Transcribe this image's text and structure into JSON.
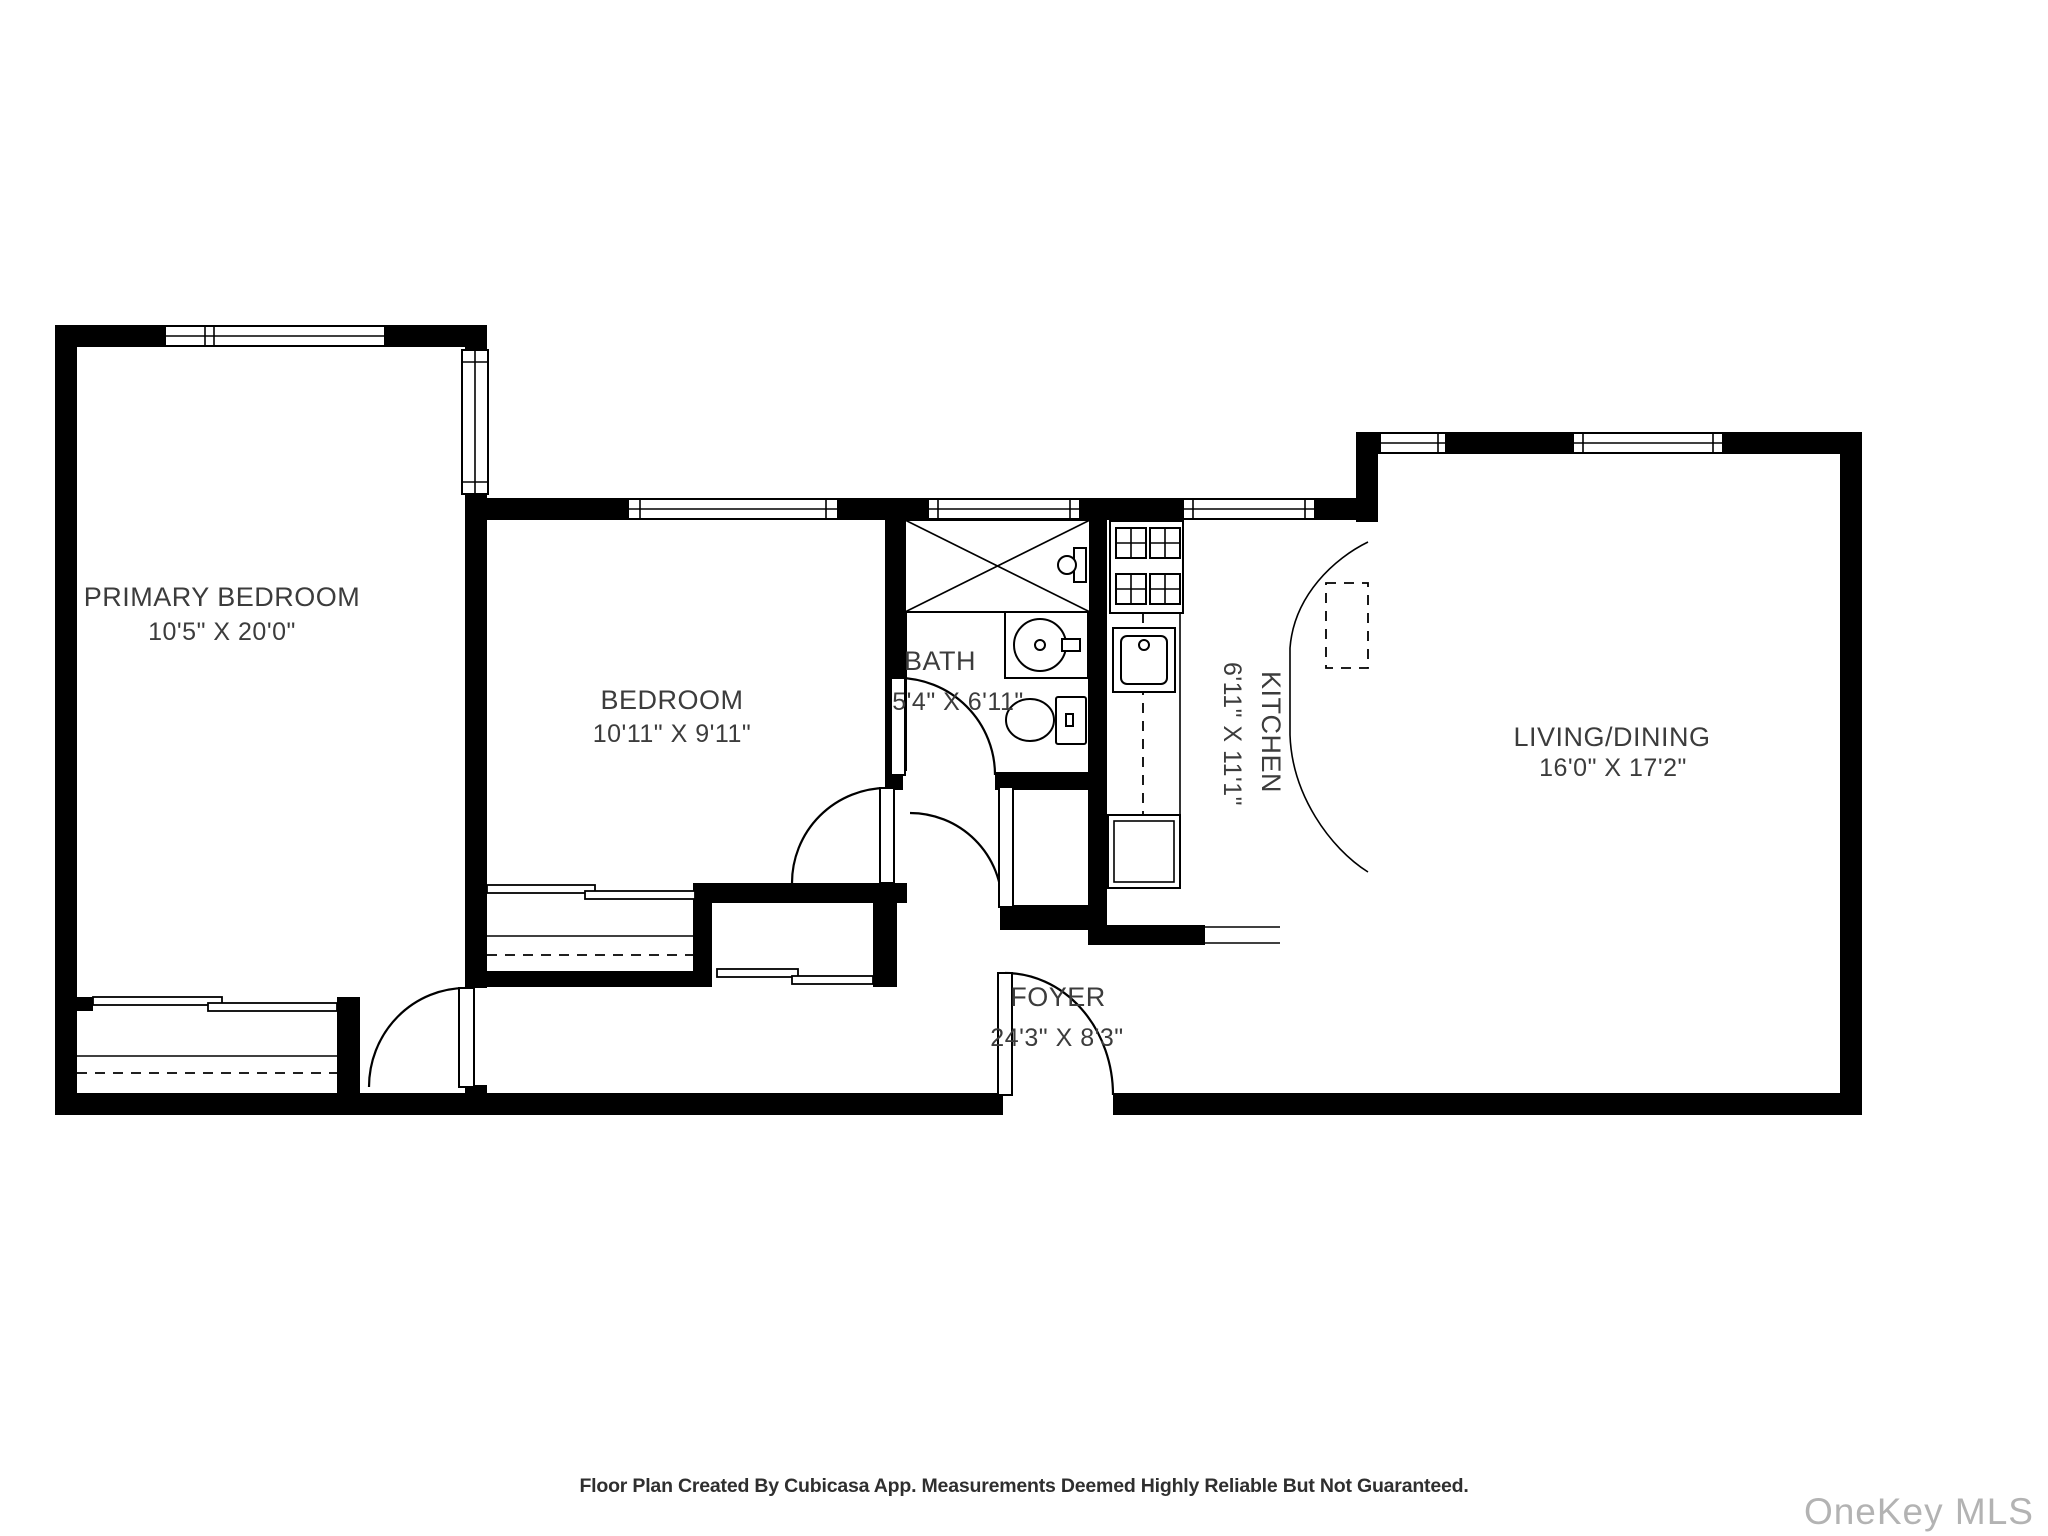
{
  "rooms": [
    {
      "name": "PRIMARY BEDROOM",
      "dims": "10'5\" X 20'0\""
    },
    {
      "name": "BEDROOM",
      "dims": "10'11\" X 9'11\""
    },
    {
      "name": "BATH",
      "dims": "5'4\" X 6'11\""
    },
    {
      "name": "KITCHEN",
      "dims": "6'11\" X 11'1\""
    },
    {
      "name": "LIVING/DINING",
      "dims": "16'0\" X 17'2\""
    },
    {
      "name": "FOYER",
      "dims": "24'3\" X 8'3\""
    }
  ],
  "footer": {
    "disclaimer": "Floor Plan Created By Cubicasa App. Measurements Deemed Highly Reliable But Not Guaranteed."
  },
  "watermark": {
    "text": "OneKey MLS"
  },
  "colors": {
    "wall": "#000000",
    "background": "#ffffff",
    "label": "#3c3c3c",
    "watermark": "#b3b3b3"
  }
}
